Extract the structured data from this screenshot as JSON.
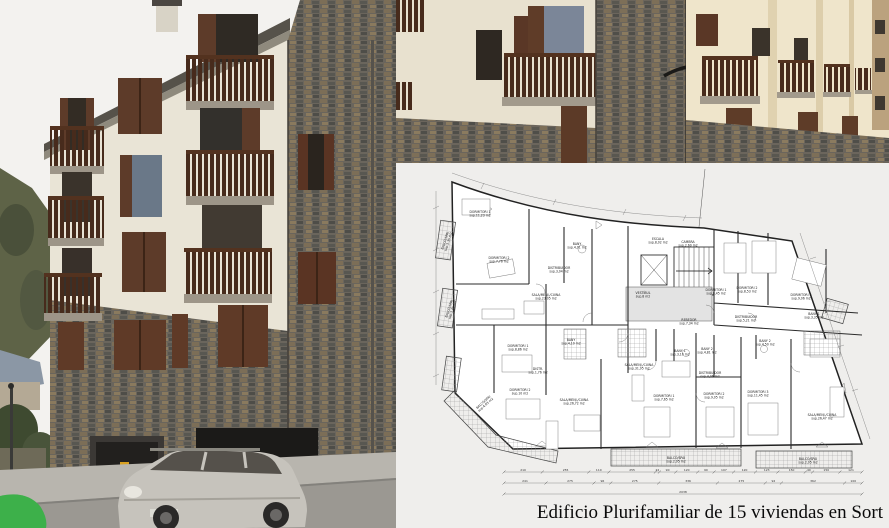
{
  "page": {
    "caption": "Edificio Plurifamiliar de 15 viviendas en Sort"
  },
  "photos": {
    "main_photo": {
      "subject": "apartment-building-corner-street-view",
      "colors": {
        "sky": "#f3f2ef",
        "stucco": "#e9e4d6",
        "stone_base": "#6a655c",
        "balcony_wood": "#4a2d1d",
        "shutter_wood": "#5d3b29",
        "hill_green": "#5e6347",
        "street": "#9b9892",
        "car_silver": "#c6c3bc",
        "green_object": "#3db04a"
      }
    },
    "facade_photo": {
      "subject": "facade-closeup-with-balconies",
      "colors": {
        "stucco": "#e8e1cf",
        "sunlit_stucco": "#efe5cb",
        "stone_base": "#6b655c",
        "balcony_wood": "#4a2d1d"
      }
    }
  },
  "floor_plan": {
    "title_hint": "planta tipus - 15 viviendas",
    "rooms": [
      {
        "name": "DORMITORI 1",
        "area": "sup.11,23 m2",
        "x": 84,
        "y": 50,
        "r": 0
      },
      {
        "name": "BALCÓ/SPAI",
        "area": "sup.1,35 m2",
        "x": 50,
        "y": 78,
        "r": -72
      },
      {
        "name": "DORMITORI 2",
        "area": "sup.7,76 m2",
        "x": 103,
        "y": 96,
        "r": 0
      },
      {
        "name": "BANY",
        "area": "sup.4,01 m2",
        "x": 181,
        "y": 82,
        "r": 0
      },
      {
        "name": "DISTRIBUIDOR",
        "area": "sup.3,04 m2",
        "x": 163,
        "y": 106,
        "r": 0
      },
      {
        "name": "SALA/MENJ./CUINA",
        "area": "sup.23,05 m2",
        "x": 150,
        "y": 133,
        "r": 0
      },
      {
        "name": "BALCÓ/SPAI",
        "area": "sup.1,45 m2",
        "x": 54,
        "y": 146,
        "r": -72
      },
      {
        "name": "ESCALA",
        "area": "sup.8,02 m2",
        "x": 262,
        "y": 77,
        "r": 0
      },
      {
        "name": "CAMBRA",
        "area": "sup.2,60 m2",
        "x": 292,
        "y": 80,
        "r": 0
      },
      {
        "name": "VESTÍBUL",
        "area": "sup.8 m2",
        "x": 247,
        "y": 131,
        "r": 0
      },
      {
        "name": "REBEDOR",
        "area": "sup.7,34 m2",
        "x": 293,
        "y": 158,
        "r": 0
      },
      {
        "name": "DORMITORI 1",
        "area": "sup.8,45 m2",
        "x": 320,
        "y": 128,
        "r": 0
      },
      {
        "name": "DORMITORI 2",
        "area": "sup.8,53 m2",
        "x": 351,
        "y": 126,
        "r": 0
      },
      {
        "name": "DORMITORI 3",
        "area": "sup.9,06 m2",
        "x": 405,
        "y": 133,
        "r": 0
      },
      {
        "name": "DISTRIBUIDOR",
        "area": "sup.5,21 m2",
        "x": 350,
        "y": 155,
        "r": 0
      },
      {
        "name": "BANY 1",
        "area": "sup.3,35 m2",
        "x": 418,
        "y": 152,
        "r": 0
      },
      {
        "name": "BANY 2",
        "area": "sup.4,50 m2",
        "x": 369,
        "y": 179,
        "r": 0
      },
      {
        "name": "DORMITORI 1",
        "area": "sup.8,86 m2",
        "x": 122,
        "y": 184,
        "r": 0
      },
      {
        "name": "BANY",
        "area": "sup.4,10 m2",
        "x": 175,
        "y": 178,
        "r": 0
      },
      {
        "name": "DISTR.",
        "area": "sup.1,76 m2",
        "x": 142,
        "y": 207,
        "r": 0
      },
      {
        "name": "DORMITORI 2",
        "area": "sup.10 m2",
        "x": 124,
        "y": 228,
        "r": 0
      },
      {
        "name": "BALCÓ/SPAI",
        "area": "sup.4,83 m2",
        "x": 88,
        "y": 240,
        "r": -42
      },
      {
        "name": "SALA/MENJ./CUINA",
        "area": "sup.26,72 m2",
        "x": 178,
        "y": 238,
        "r": 0
      },
      {
        "name": "SALA/MENJ./CUINA",
        "area": "sup.31,95 m2",
        "x": 243,
        "y": 203,
        "r": 0
      },
      {
        "name": "BANY 1",
        "area": "sup.3,10 m2",
        "x": 284,
        "y": 189,
        "r": 0
      },
      {
        "name": "BANY 2",
        "area": "sup.4,81 m2",
        "x": 311,
        "y": 187,
        "r": 0
      },
      {
        "name": "DISTRIBUIDOR",
        "area": "sup.4,06 m2",
        "x": 314,
        "y": 211,
        "r": 0
      },
      {
        "name": "DORMITORI 1",
        "area": "sup.7,65 m2",
        "x": 268,
        "y": 234,
        "r": 0
      },
      {
        "name": "DORMITORI 2",
        "area": "sup.9,05 m2",
        "x": 318,
        "y": 232,
        "r": 0
      },
      {
        "name": "DORMITORI 3",
        "area": "sup.11,45 m2",
        "x": 362,
        "y": 230,
        "r": 0
      },
      {
        "name": "SALA/MENJ./CUINA",
        "area": "sup.26,47 m2",
        "x": 426,
        "y": 253,
        "r": 0
      },
      {
        "name": "BALCÓ/SPAI",
        "area": "sup.2,95 m2",
        "x": 280,
        "y": 296,
        "r": 0
      },
      {
        "name": "BALCÓ/SPAI",
        "area": "sup.2,05 m2",
        "x": 412,
        "y": 297,
        "r": 0
      }
    ],
    "dim_x1": 108,
    "dim_x2": 466,
    "dim_rows": [
      {
        "y": 309,
        "values": [
          "210",
          "255",
          "110",
          "255",
          "22",
          "90",
          "120",
          "90",
          "107",
          "120",
          "123",
          "150",
          "40",
          "150",
          "121"
        ]
      },
      {
        "y": 320,
        "values": [
          "241",
          "275",
          "96",
          "275",
          "336",
          "275",
          "92",
          "362",
          "100"
        ]
      },
      {
        "y": 331,
        "values": [
          "2038"
        ]
      }
    ]
  }
}
